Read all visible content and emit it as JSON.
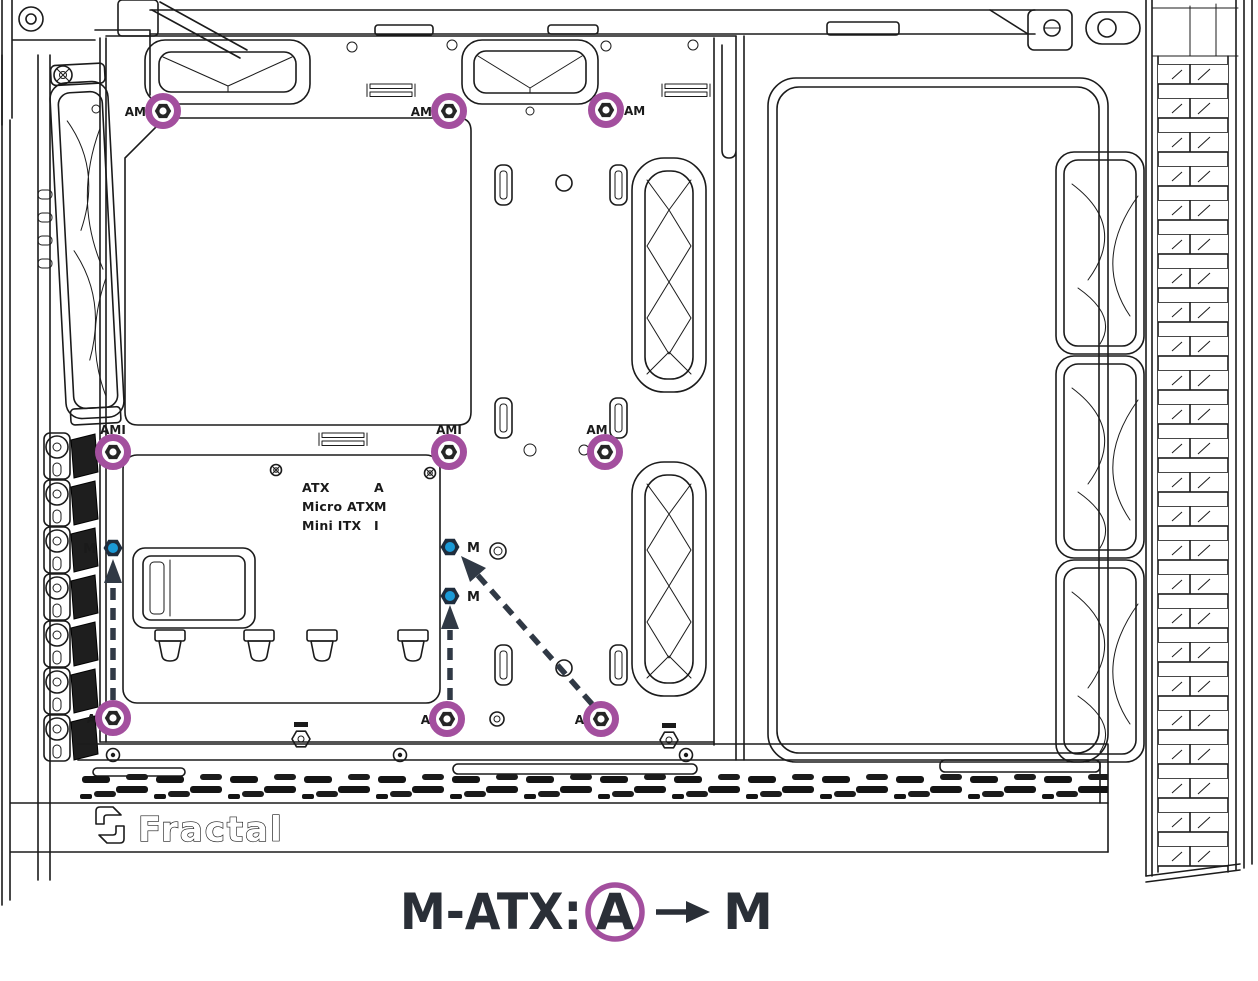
{
  "colors": {
    "line": "#1b1b1b",
    "highlight_purple": "#A34F9E",
    "standoff_blue": "#1B9AD7",
    "standoff_hex_dark": "#1F2C3C",
    "arrow_dark": "#303945",
    "caption_text": "#2A2F37",
    "vent_dark": "#1e1e1e"
  },
  "brand": {
    "logo_text": "Fractal"
  },
  "legend": {
    "rows": [
      {
        "name": "ATX",
        "code": "A"
      },
      {
        "name": "Micro ATX",
        "code": "M"
      },
      {
        "name": "Mini ITX",
        "code": "I"
      }
    ]
  },
  "standoffs": {
    "circled": [
      {
        "label": "AM"
      },
      {
        "label": "AM"
      },
      {
        "label": "AM"
      },
      {
        "label": "AMI"
      },
      {
        "label": "AMI"
      },
      {
        "label": "AM"
      },
      {
        "label": "A"
      },
      {
        "label": "A"
      },
      {
        "label": "A"
      }
    ],
    "m_positions": [
      {
        "label": "M"
      },
      {
        "label": "M"
      },
      {
        "label": "M"
      }
    ]
  },
  "caption": {
    "prefix": "M-ATX:",
    "circled_letter": "A",
    "target_letter": "M"
  }
}
